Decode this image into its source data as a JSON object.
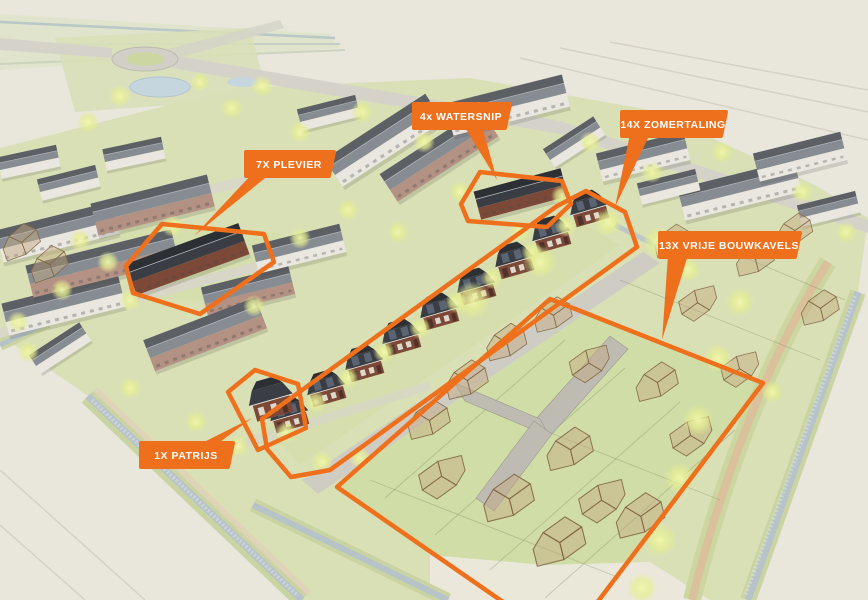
{
  "scene": {
    "type": "3d-aerial-site-plan",
    "description": "Artist impression of a Dutch new-build housing development with highlighted plots"
  },
  "labels": {
    "plevier": {
      "text": "7X PLEVIER"
    },
    "watersnip": {
      "text": "4x WATERSNIP"
    },
    "zomertaling": {
      "text": "14X ZOMERTALING"
    },
    "bouwkavels": {
      "text": "13X VRIJE BOUWKAVELS"
    },
    "patrijs": {
      "text": "1X PATRIJS"
    }
  },
  "colors": {
    "accent": "#EF701C",
    "background": "#E9E6DC",
    "grass": "#D9E0B5",
    "grass_bright": "#CFDCA4",
    "water": "#B7C2C9",
    "bank": "#C9D4A2",
    "road": "#D5D3C9",
    "street": "#CFCDC3",
    "roof_dark": "#5C6065",
    "roof_light": "#878C92",
    "wall": "#E9E7E0",
    "brick": "#B39183",
    "highlight_roof": "#3A3E44",
    "highlight_brick": "#7C4938",
    "ghost": "#C4AA82",
    "tree": "#E5EE92",
    "path_tan": "#DBBE9A",
    "pond": "#C6D6DE"
  }
}
